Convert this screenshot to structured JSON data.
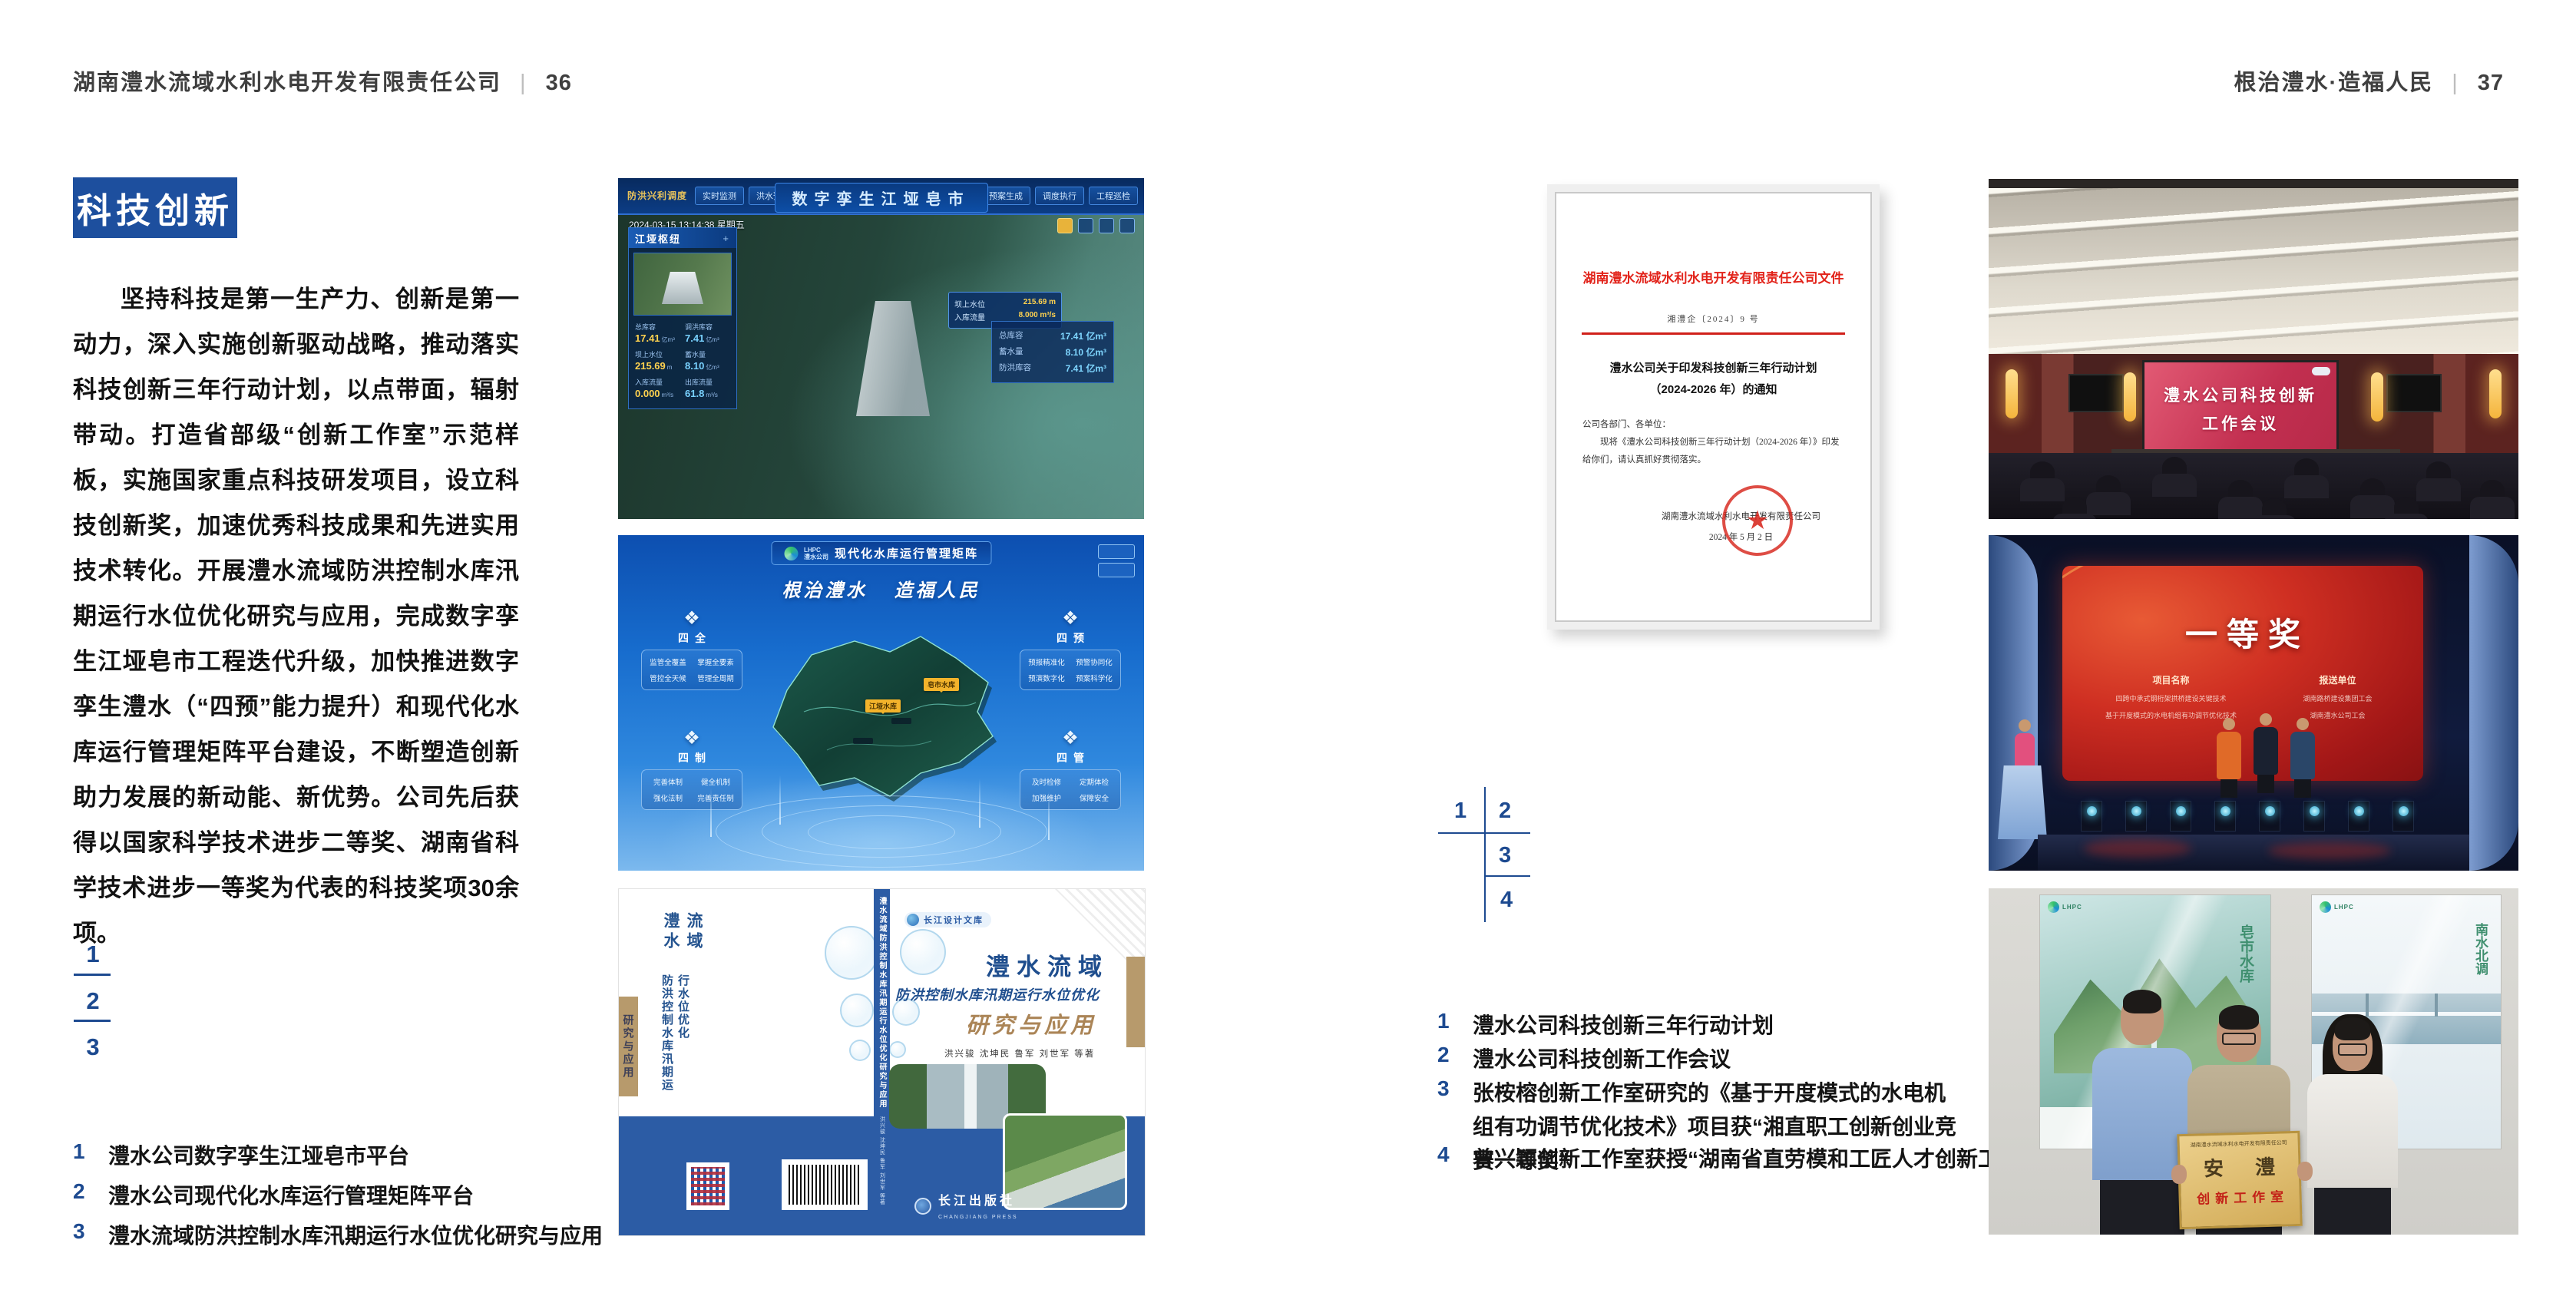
{
  "left_page": {
    "header": {
      "company": "湖南澧水流域水利水电开发有限责任公司",
      "divider": "|",
      "page": "36"
    },
    "badge": "科技创新",
    "paragraph": "坚持科技是第一生产力、创新是第一动力，深入实施创新驱动战略，推动落实科技创新三年行动计划，以点带面，辐射带动。打造省部级“创新工作室”示范样板，实施国家重点科技研发项目，设立科技创新奖，加速优秀科技成果和先进实用技术转化。开展澧水流域防洪控制水库汛期运行水位优化研究与应用，完成数字孪生江垭皂市工程迭代升级，加快推进数字孪生澧水（“四预”能力提升）和现代化水库运行管理矩阵平台建设，不断塑造创新助力发展的新动能、新优势。公司先后获得以国家科学技术进步二等奖、湖南省科学技术进步一等奖为代表的科技奖项30余项。",
    "nums": [
      "1",
      "2",
      "3"
    ],
    "captions": [
      {
        "num": "1",
        "text": "澧水公司数字孪生江垭皂市平台"
      },
      {
        "num": "2",
        "text": "澧水公司现代化水库运行管理矩阵平台"
      },
      {
        "num": "3",
        "text": "澧水流域防洪控制水库汛期运行水位优化研究与应用"
      }
    ]
  },
  "right_page": {
    "header": {
      "slogan": "根治澧水·造福人民",
      "divider": "|",
      "page": "37"
    },
    "nums": [
      "1",
      "2",
      "3",
      "4"
    ],
    "captions": [
      {
        "num": "1",
        "text": "澧水公司科技创新三年行动计划"
      },
      {
        "num": "2",
        "text": "澧水公司科技创新工作会议"
      },
      {
        "num": "3",
        "text": "张桉榕创新工作室研究的《基于开度模式的水电机组有功调节优化技术》项目获“湘直职工创新创业竞赛一等奖”"
      },
      {
        "num": "4",
        "text": "曾兴颖创新工作室获授“湖南省直劳模和工匠人才创新工作室”"
      }
    ]
  },
  "fig_twin": {
    "title": "数字孪生江垭皂市",
    "menu_label": "防洪兴利调度",
    "tabs_left": [
      "实时监测",
      "洪水预报",
      "防洪预警"
    ],
    "tabs_right": [
      "态势预测",
      "预案生成",
      "调度执行",
      "工程巡检"
    ],
    "datetime": "2024-03-15 13:14:38 星期五",
    "panel_title": "江垭枢纽",
    "panel_plus": "+",
    "stats": [
      {
        "label": "总库容",
        "value": "17.41",
        "unit": "亿m³"
      },
      {
        "label": "调洪库容",
        "value": "7.41",
        "unit": "亿m³"
      },
      {
        "label": "坝上水位",
        "value": "215.69",
        "unit": "m"
      },
      {
        "label": "蓄水量",
        "value": "8.10",
        "unit": "亿m³"
      },
      {
        "label": "入库流量",
        "value": "0.000",
        "unit": "m³/s"
      },
      {
        "label": "出库流量",
        "value": "61.8",
        "unit": "m³/s"
      }
    ],
    "tooltip": [
      {
        "label": "坝上水位",
        "value": "215.69 m"
      },
      {
        "label": "入库流量",
        "value": "8.000 m³/s"
      }
    ],
    "side_stats": [
      {
        "label": "总库容",
        "value": "17.41 亿m³"
      },
      {
        "label": "蓄水量",
        "value": "8.10 亿m³"
      },
      {
        "label": "防洪库容",
        "value": "7.41 亿m³"
      }
    ]
  },
  "fig_matrix": {
    "logo_line1": "LHPC",
    "logo_line2": "澧水公司",
    "title": "现代化水库运行管理矩阵",
    "slogan": "根治澧水 造福人民",
    "panel_icon": "❖",
    "panels": [
      {
        "title": "四全",
        "items": [
          "监管全覆盖",
          "掌握全要素",
          "管控全天候",
          "管理全周期"
        ]
      },
      {
        "title": "四预",
        "items": [
          "预报精准化",
          "预警协同化",
          "预演数字化",
          "预案科学化"
        ]
      },
      {
        "title": "四制",
        "items": [
          "完善体制",
          "健全机制",
          "强化法制",
          "完善责任制"
        ]
      },
      {
        "title": "四管",
        "items": [
          "及时检修",
          "定期体检",
          "加强维护",
          "保障安全"
        ]
      }
    ],
    "markers": [
      "皂市水库",
      "江垭水库"
    ]
  },
  "fig_book": {
    "series": "长江设计文库",
    "title1": "澧水流域",
    "title2": "防洪控制水库汛期运行水位优化",
    "title3": "研究与应用",
    "authors": "洪兴骏 沈坤民 鲁军 刘世军 等著",
    "publisher": "长江出版社",
    "publisher_en": "CHANGJIANG PRESS",
    "spine_title": "澧水流域防洪控制水库汛期运行水位优化研究与应用",
    "spine_authors": "洪兴骏 沈坤民 鲁军 刘世军 等著"
  },
  "doc": {
    "header": "湖南澧水流域水利水电开发有限责任公司文件",
    "number": "湘澧企〔2024〕9 号",
    "title_line1": "澧水公司关于印发科技创新三年行动计划",
    "title_line2": "（2024-2026 年）的通知",
    "salutation": "公司各部门、各单位：",
    "body": "现将《澧水公司科技创新三年行动计划（2024-2026 年）》印发给你们，请认真抓好贯彻落实。",
    "signer": "湖南澧水流域水利水电开发有限责任公司",
    "date": "2024 年 5 月 2 日",
    "seal_star": "★"
  },
  "photo_meeting": {
    "screen_line1": "澧水公司科技创新",
    "screen_line2": "工作会议"
  },
  "photo_award": {
    "title": "一等奖",
    "col1_header": "项目名称",
    "col2_header": "报送单位",
    "rows": [
      {
        "project": "四跨中承式钢桁架拱桥建设关键技术",
        "unit": "湖南路桥建设集团工会"
      },
      {
        "project": "基于开度模式的水电机组有功调节优化技术",
        "unit": "湖南澧水公司工会"
      }
    ]
  },
  "photo_group": {
    "plaque_header": "湖南澧水流域水利水电开发有限责任公司",
    "plaque_title": "安 澧",
    "plaque_subtitle": "创新工作室",
    "poster_left_text": "皂市水库",
    "poster_right_text": "南水北调"
  }
}
